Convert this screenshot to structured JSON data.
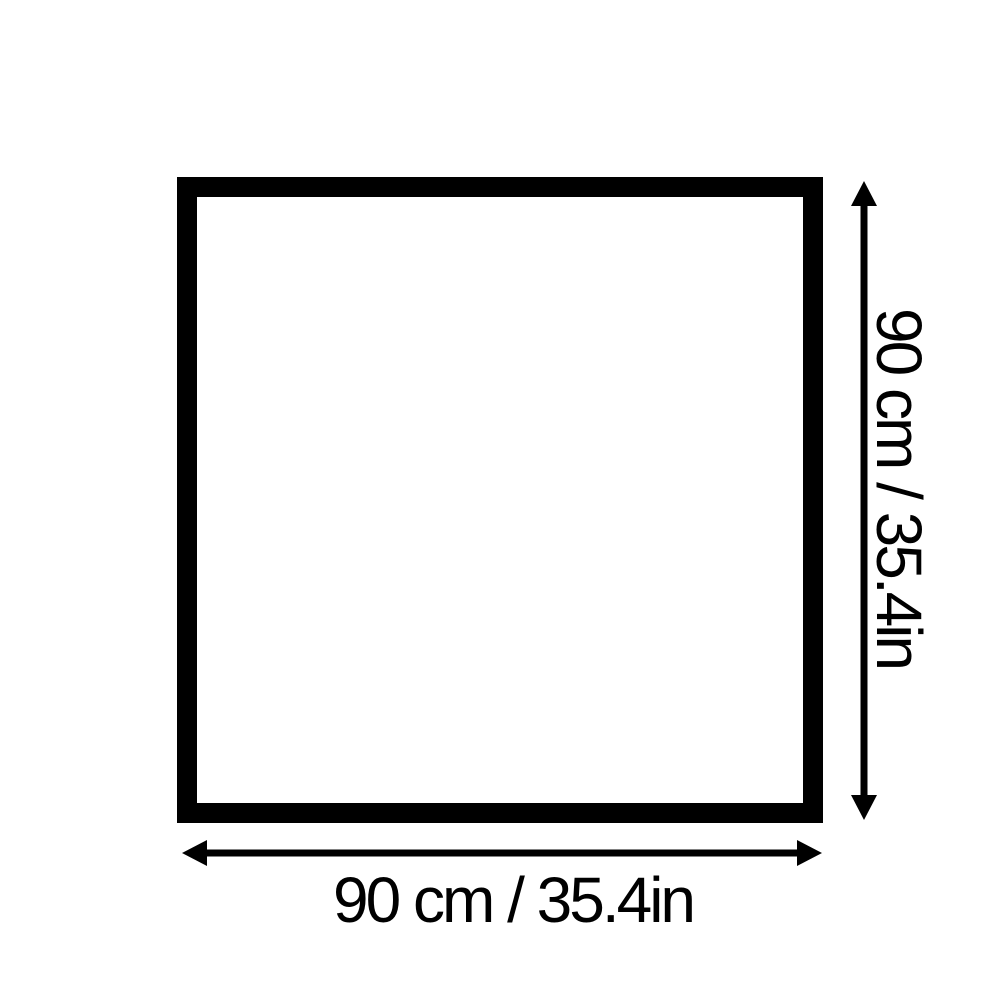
{
  "diagram": {
    "type": "product-dimension-diagram",
    "shape": "square",
    "labels": {
      "width": "90 cm / 35.4in",
      "height": "90 cm / 35.4in"
    },
    "measurements": {
      "width_cm": "90",
      "height_cm": "90",
      "width_in": "35.4",
      "height_in": "35.4"
    },
    "colors": {
      "outline": "#000000",
      "background": "#ffffff",
      "text": "#000000"
    }
  }
}
